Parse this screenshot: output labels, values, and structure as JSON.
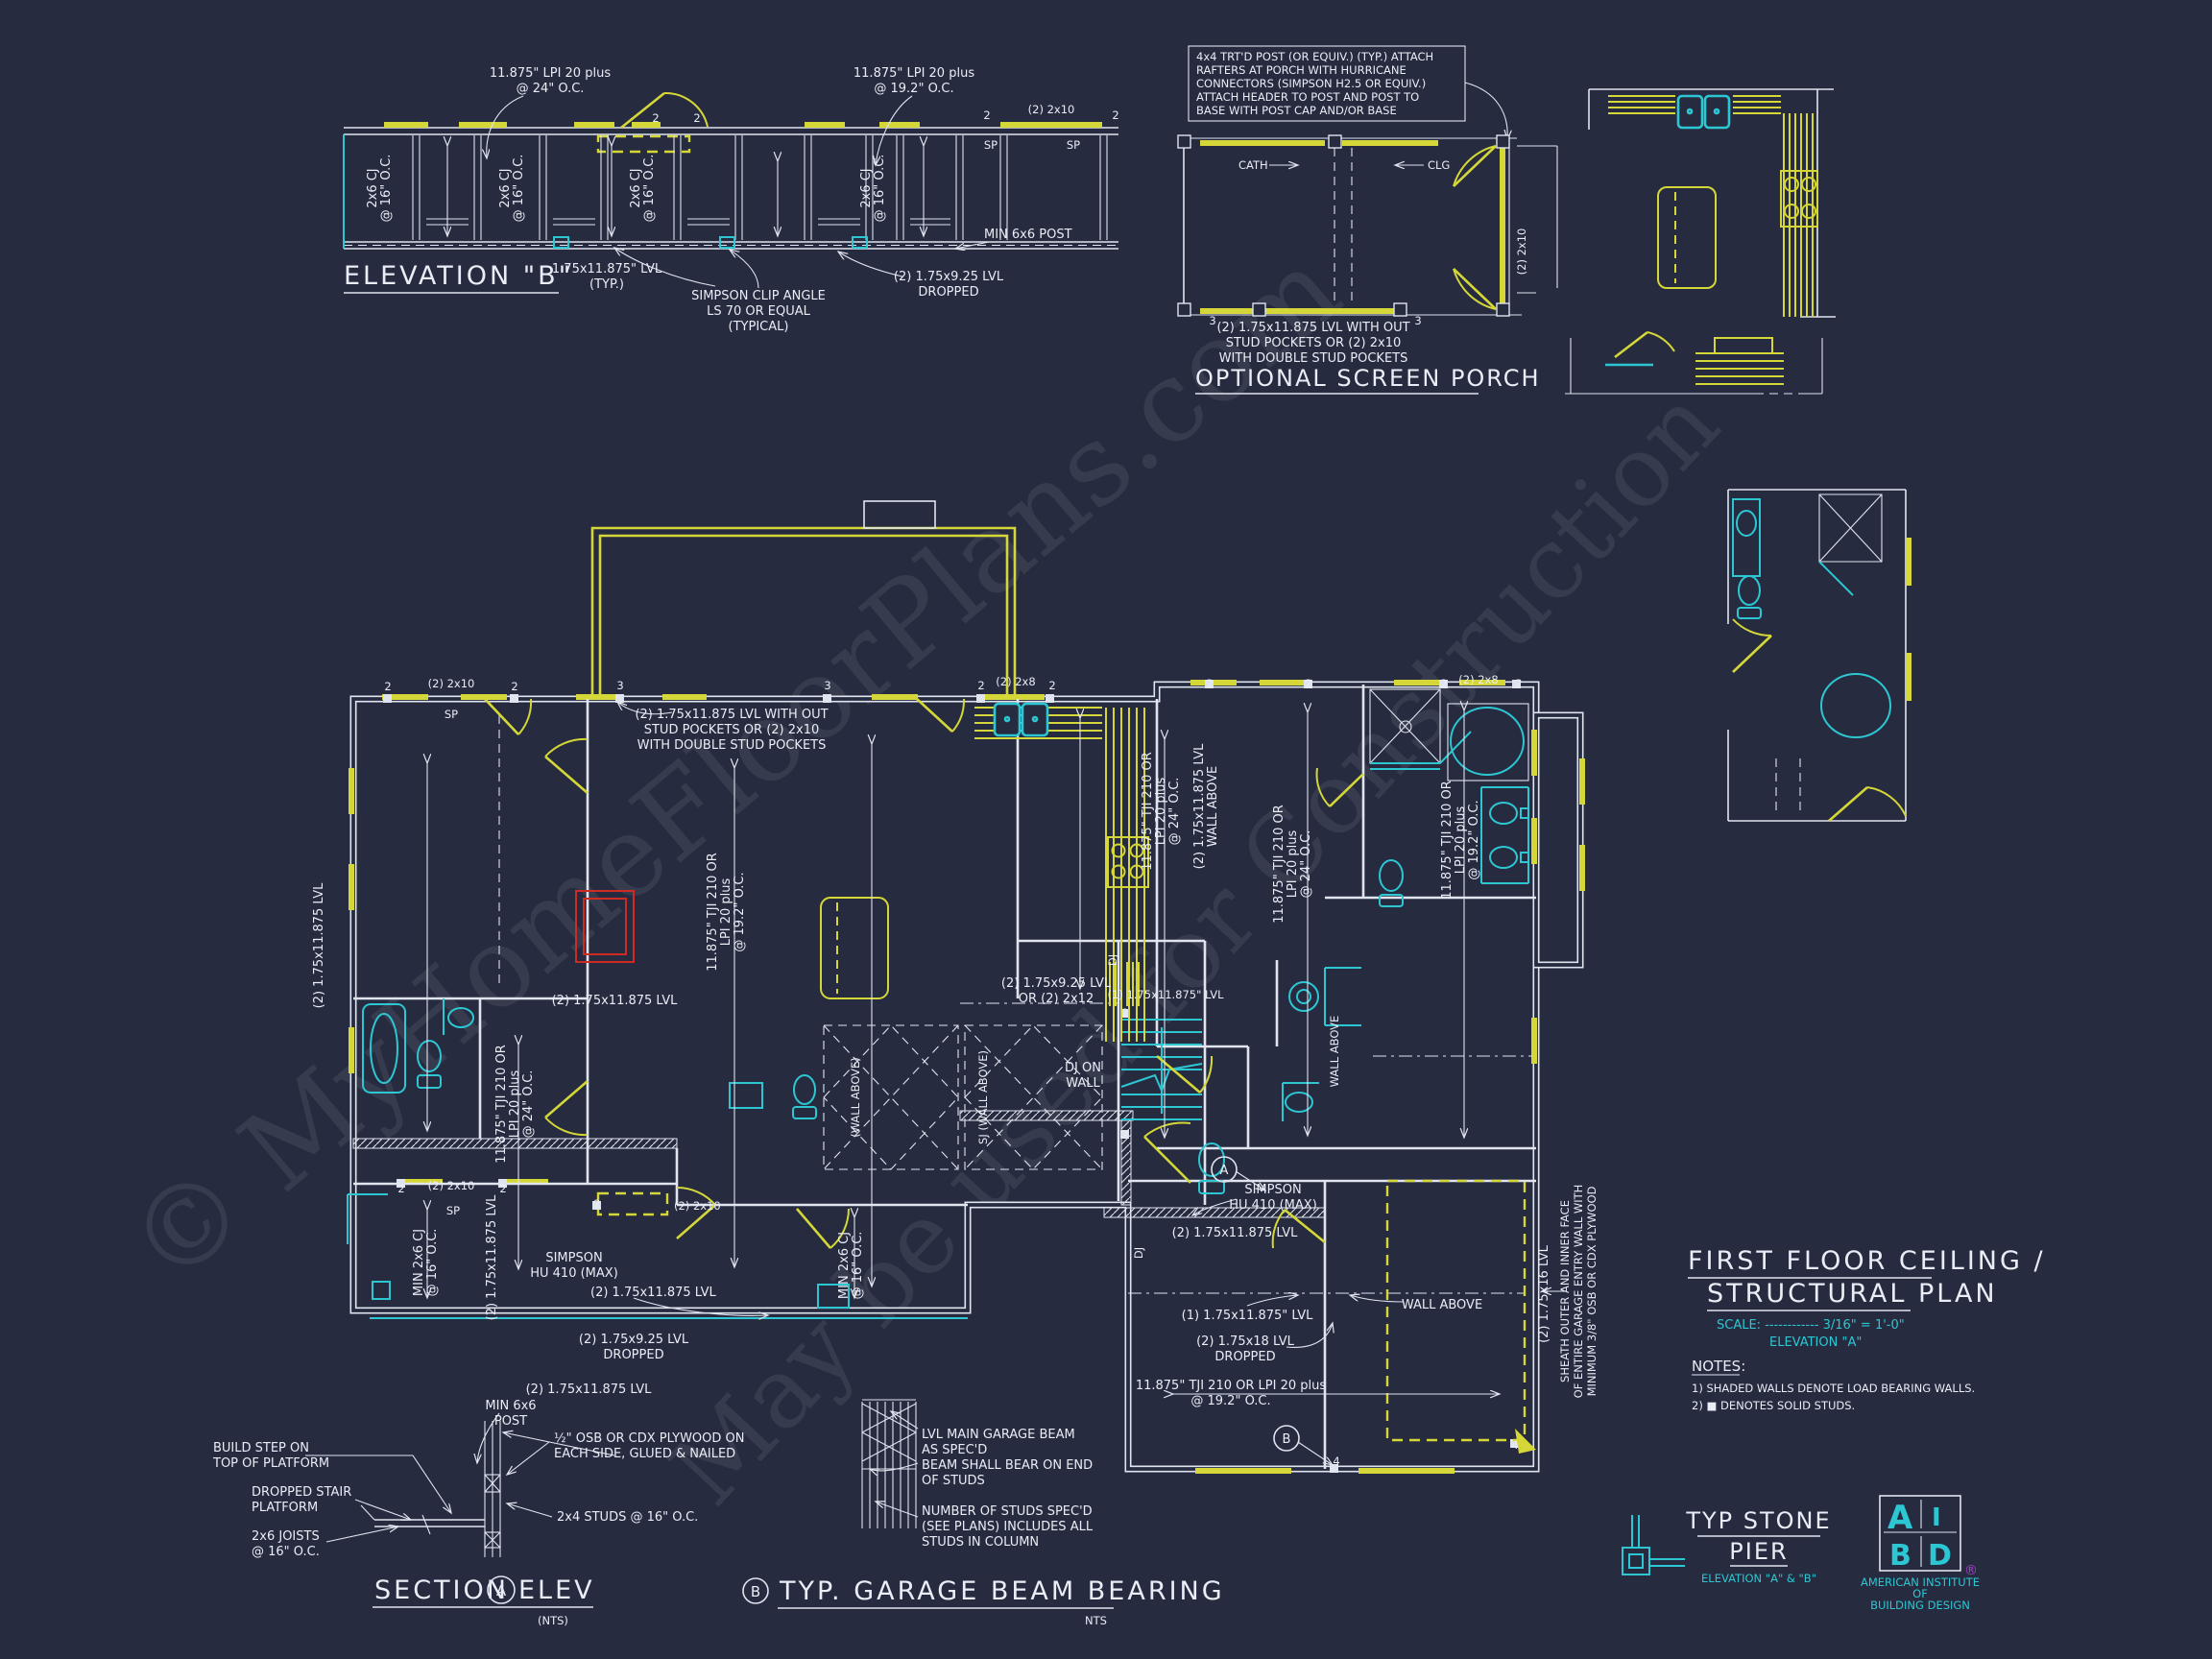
{
  "colors": {
    "background": "#262b40",
    "linework": "#dfe4ee",
    "load_bearing_yellow": "#d4d737",
    "fixture_cyan": "#2cc7d2",
    "fireplace_red": "#cf2b25",
    "registered_purple": "#b03fd4"
  },
  "watermarks": {
    "line1": "© MyHomeFloorPlans.com",
    "line2": "May be used for Construction"
  },
  "elevation_b": {
    "title": "ELEVATION \"B\"",
    "lpi24_l1": "11.875\" LPI 20 plus",
    "lpi24_l2": "@ 24\" O.C.",
    "lpi192_l1": "11.875\" LPI 20 plus",
    "lpi192_l2": "@ 19.2\" O.C.",
    "cj_l1": "2x6 CJ",
    "cj_l2": "@ 16\" O.C.",
    "hdr_2x10": "(2) 2x10",
    "sp": "SP",
    "m2": "2",
    "lvl_typ_l1": "1.75x11.875\" LVL",
    "lvl_typ_l2": "(TYP.)",
    "clip_l1": "SIMPSON CLIP ANGLE",
    "clip_l2": "LS 70 OR EQUAL",
    "clip_l3": "(TYPICAL)",
    "dropped_l1": "(2) 1.75x9.25 LVL",
    "dropped_l2": "DROPPED",
    "post": "MIN 6x6 POST"
  },
  "screen_porch": {
    "note": [
      "4x4 TRT'D POST (OR EQUIV.) (TYP.) ATTACH",
      "RAFTERS AT PORCH WITH HURRICANE",
      "CONNECTORS (SIMPSON H2.5 OR EQUIV.)",
      "ATTACH HEADER TO POST AND POST TO",
      "BASE WITH POST CAP AND/OR BASE"
    ],
    "cath": "CATH",
    "clg": "CLG",
    "side": "(2) 2x10",
    "m3": "3",
    "lvl_note": [
      "(2) 1.75x11.875 LVL WITH OUT",
      "STUD POCKETS OR (2) 2x10",
      "WITH DOUBLE STUD POCKETS"
    ],
    "title": "OPTIONAL SCREEN PORCH"
  },
  "plan": {
    "lvl_note": [
      "(2) 1.75x11.875 LVL WITH OUT",
      "STUD POCKETS OR (2) 2x10",
      "WITH DOUBLE STUD POCKETS"
    ],
    "hdr_2x10": "(2) 2x10",
    "hdr_2x8": "(2) 2x8",
    "sp": "SP",
    "m2": "2",
    "m3": "3",
    "m4": "4",
    "tji24": [
      "11.875\" TJI 210 OR",
      "LPI 20 plus",
      "@ 24\" O.C."
    ],
    "tji192": [
      "11.875\" TJI 210 OR",
      "LPI 20 plus",
      "@ 19.2\" O.C."
    ],
    "lvl11875": "(2) 1.75x11.875 LVL",
    "lvl1_11875": "(1) 1.75x11.875\" LVL",
    "wall_above": "WALL ABOVE",
    "lvl_wa_l1": "(2) 1.75x11.875 LVL",
    "lvl_wa_l2": "WALL ABOVE",
    "min_cj_l1": "MIN 2x6 CJ",
    "min_cj_l2": "@ 16\" O.C.",
    "lvl925_l1": "(2) 1.75x9.25 LVL",
    "lvl925_l2": "OR (2) 2x12",
    "lvl925d_l1": "(2) 1.75x9.25 LVL",
    "lvl925d_l2": "DROPPED",
    "dj": "DJ",
    "dj_on_l1": "DJ ON",
    "dj_on_l2": "WALL",
    "sj": "SJ (WALL ABOVE)",
    "sj2": "(WALL ABOVE)",
    "simpson_l1": "SIMPSON",
    "simpson_l2": "HU 410 (MAX)",
    "post_l1": "MIN 6x6",
    "post_l2": "POST",
    "lvl18_l1": "(2) 1.75x18 LVL",
    "lvl18_l2": "DROPPED",
    "tji192h_l1": "11.875\" TJI 210 OR LPI 20 plus",
    "tji192h_l2": "@ 19.2\" O.C.",
    "lvl16": "(2) 1.75x16 LVL",
    "sheath": [
      "SHEATH OUTER AND INNER FACE",
      "OF ENTIRE GARAGE ENTRY WALL WITH",
      "MINIMUM 3/8\" OSB OR CDX PLYWOOD"
    ],
    "callout_a": "A",
    "callout_b": "B"
  },
  "title_block": {
    "title_l1": "FIRST FLOOR CEILING /",
    "title_l2": "STRUCTURAL PLAN",
    "scale": "SCALE: ------------ 3/16\" = 1'-0\"",
    "elevation": "ELEVATION \"A\"",
    "notes_title": "NOTES:",
    "note1": "1) SHADED WALLS DENOTE LOAD BEARING WALLS.",
    "note2": "2) ■ DENOTES SOLID STUDS."
  },
  "section_a": {
    "build_l1": "BUILD STEP ON",
    "build_l2": "TOP OF PLATFORM",
    "dropped_l1": "DROPPED STAIR",
    "dropped_l2": "PLATFORM",
    "joists_l1": "2x6 JOISTS",
    "joists_l2": "@ 16\" O.C.",
    "osb_l1": "½\" OSB OR CDX PLYWOOD ON",
    "osb_l2": "EACH SIDE,  GLUED & NAILED",
    "studs": "2x4 STUDS @ 16\" O.C.",
    "title_pre": "SECTION",
    "callout": "A",
    "title_post": "ELEV",
    "nts": "(NTS)"
  },
  "garage_beam": {
    "lvl_l1": "LVL MAIN GARAGE BEAM",
    "lvl_l2": "AS SPEC'D",
    "bear_l1": "BEAM SHALL BEAR ON END",
    "bear_l2": "OF STUDS",
    "studs_l1": "NUMBER OF STUDS SPEC'D",
    "studs_l2": "(SEE PLANS) INCLUDES ALL",
    "studs_l3": "STUDS IN COLUMN",
    "callout": "B",
    "title": "TYP. GARAGE BEAM BEARING",
    "nts": "NTS"
  },
  "stone_pier": {
    "title_l1": "TYP STONE",
    "title_l2": "PIER",
    "subtitle": "ELEVATION \"A\" & \"B\""
  },
  "aibd": {
    "a": "A",
    "i": "I",
    "b": "B",
    "d": "D",
    "reg": "®",
    "org_l1": "AMERICAN INSTITUTE",
    "org_l2": "OF",
    "org_l3": "BUILDING DESIGN"
  }
}
